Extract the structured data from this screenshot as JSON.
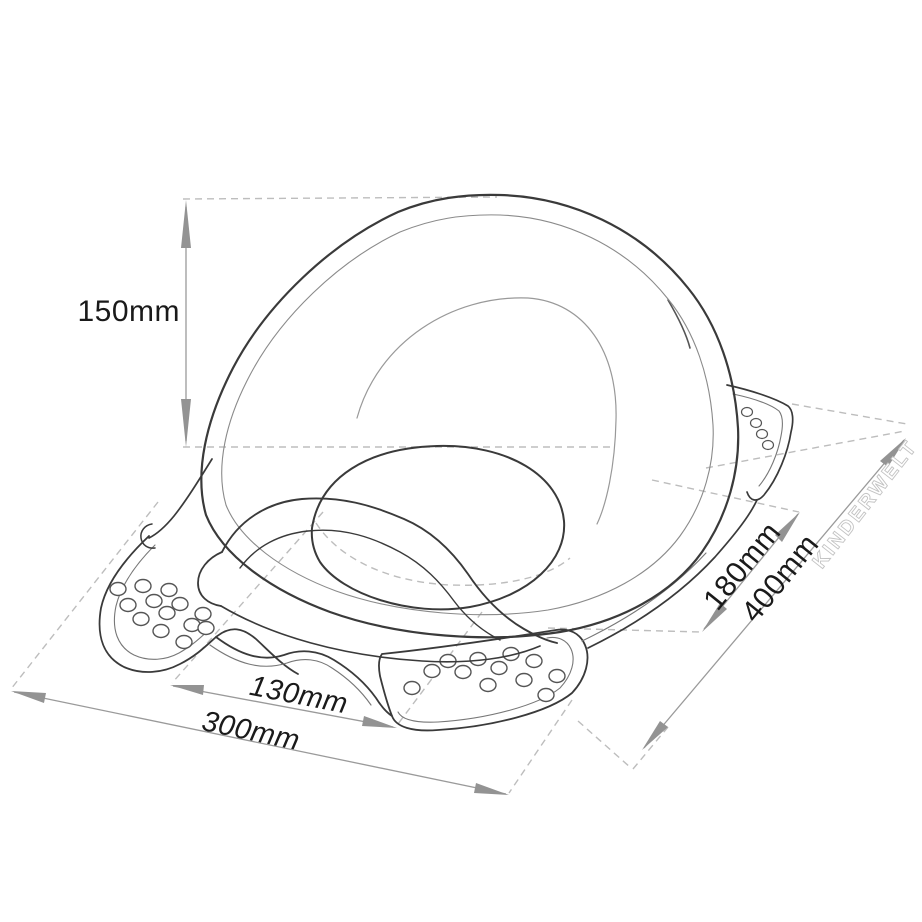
{
  "drawing": {
    "subject": "toilet-trainer-seat-dimension-diagram",
    "background": "#ffffff",
    "colors": {
      "outline": "#3a3a3a",
      "thin_line": "#8a8a8a",
      "dashed_line": "#bdbdbd",
      "dimension_line": "#9a9a9a",
      "arrow_fill": "#939393",
      "label_text": "#1a1a1a",
      "watermark": "#c3c3c3"
    },
    "dimensions": {
      "height": {
        "label": "150mm",
        "orientation": "vertical"
      },
      "inner_width": {
        "label": "130mm",
        "orientation": "width-axis"
      },
      "outer_width": {
        "label": "300mm",
        "orientation": "width-axis"
      },
      "inner_depth": {
        "label": "180mm",
        "orientation": "depth-axis"
      },
      "outer_depth": {
        "label": "400mm",
        "orientation": "depth-axis"
      }
    },
    "watermark": {
      "text": "KINDERWELT",
      "icon": "gear-icon",
      "icon_glyph": "⚙"
    }
  }
}
